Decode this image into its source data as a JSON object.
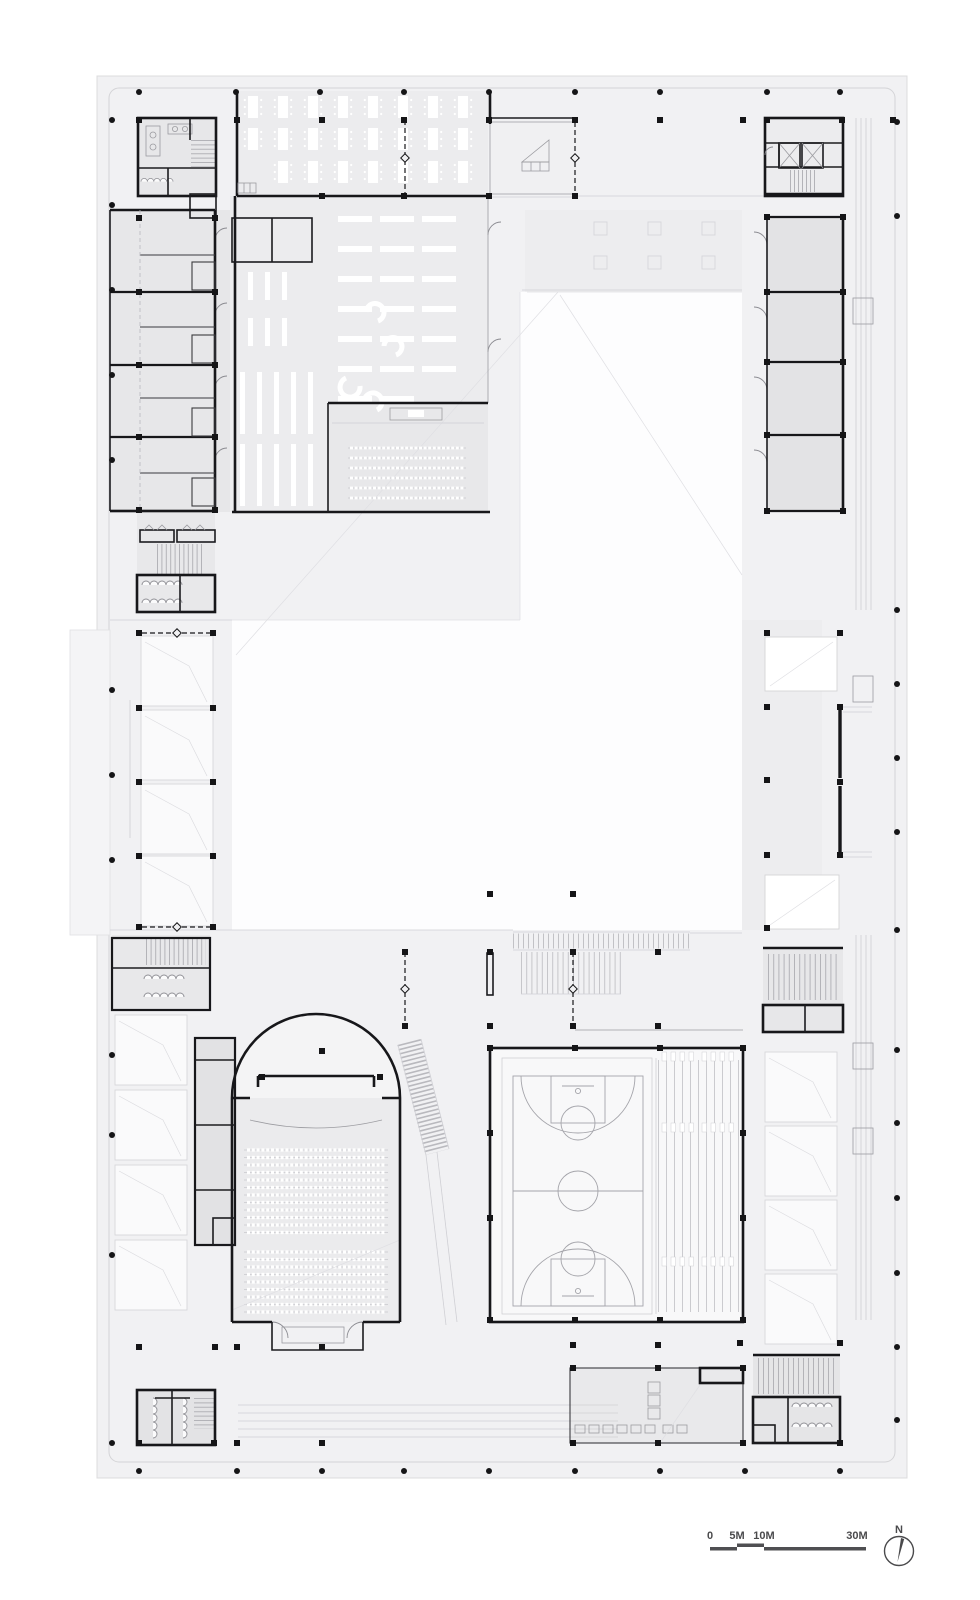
{
  "drawing": {
    "type": "architectural-floor-plan",
    "plan_features": [
      "column-grid",
      "hall-with-table-rows",
      "entrance-hall",
      "elevator-core",
      "stair-cores",
      "toilet-blocks",
      "room-wing-left",
      "room-wing-right",
      "library-bookshelves",
      "reading-tables",
      "lecture-room",
      "central-courtyard",
      "courtyard-entry-stairs",
      "skylights",
      "display-wall",
      "auditorium-arched-stage",
      "auditorium-seating",
      "access-ramp",
      "basketball-court",
      "bleachers",
      "locker-room"
    ]
  },
  "scale_bar": {
    "labels": [
      "0",
      "5M",
      "10M",
      "30M"
    ]
  },
  "compass": {
    "north_label": "N"
  },
  "palette": {
    "sheet": "#f1f1f3",
    "wall": "#17171a",
    "room_fill": "#e7e7e9",
    "void_fill": "#fdfdfe",
    "detail": "#9b9ba0",
    "annotation": "#4a4a4c"
  }
}
